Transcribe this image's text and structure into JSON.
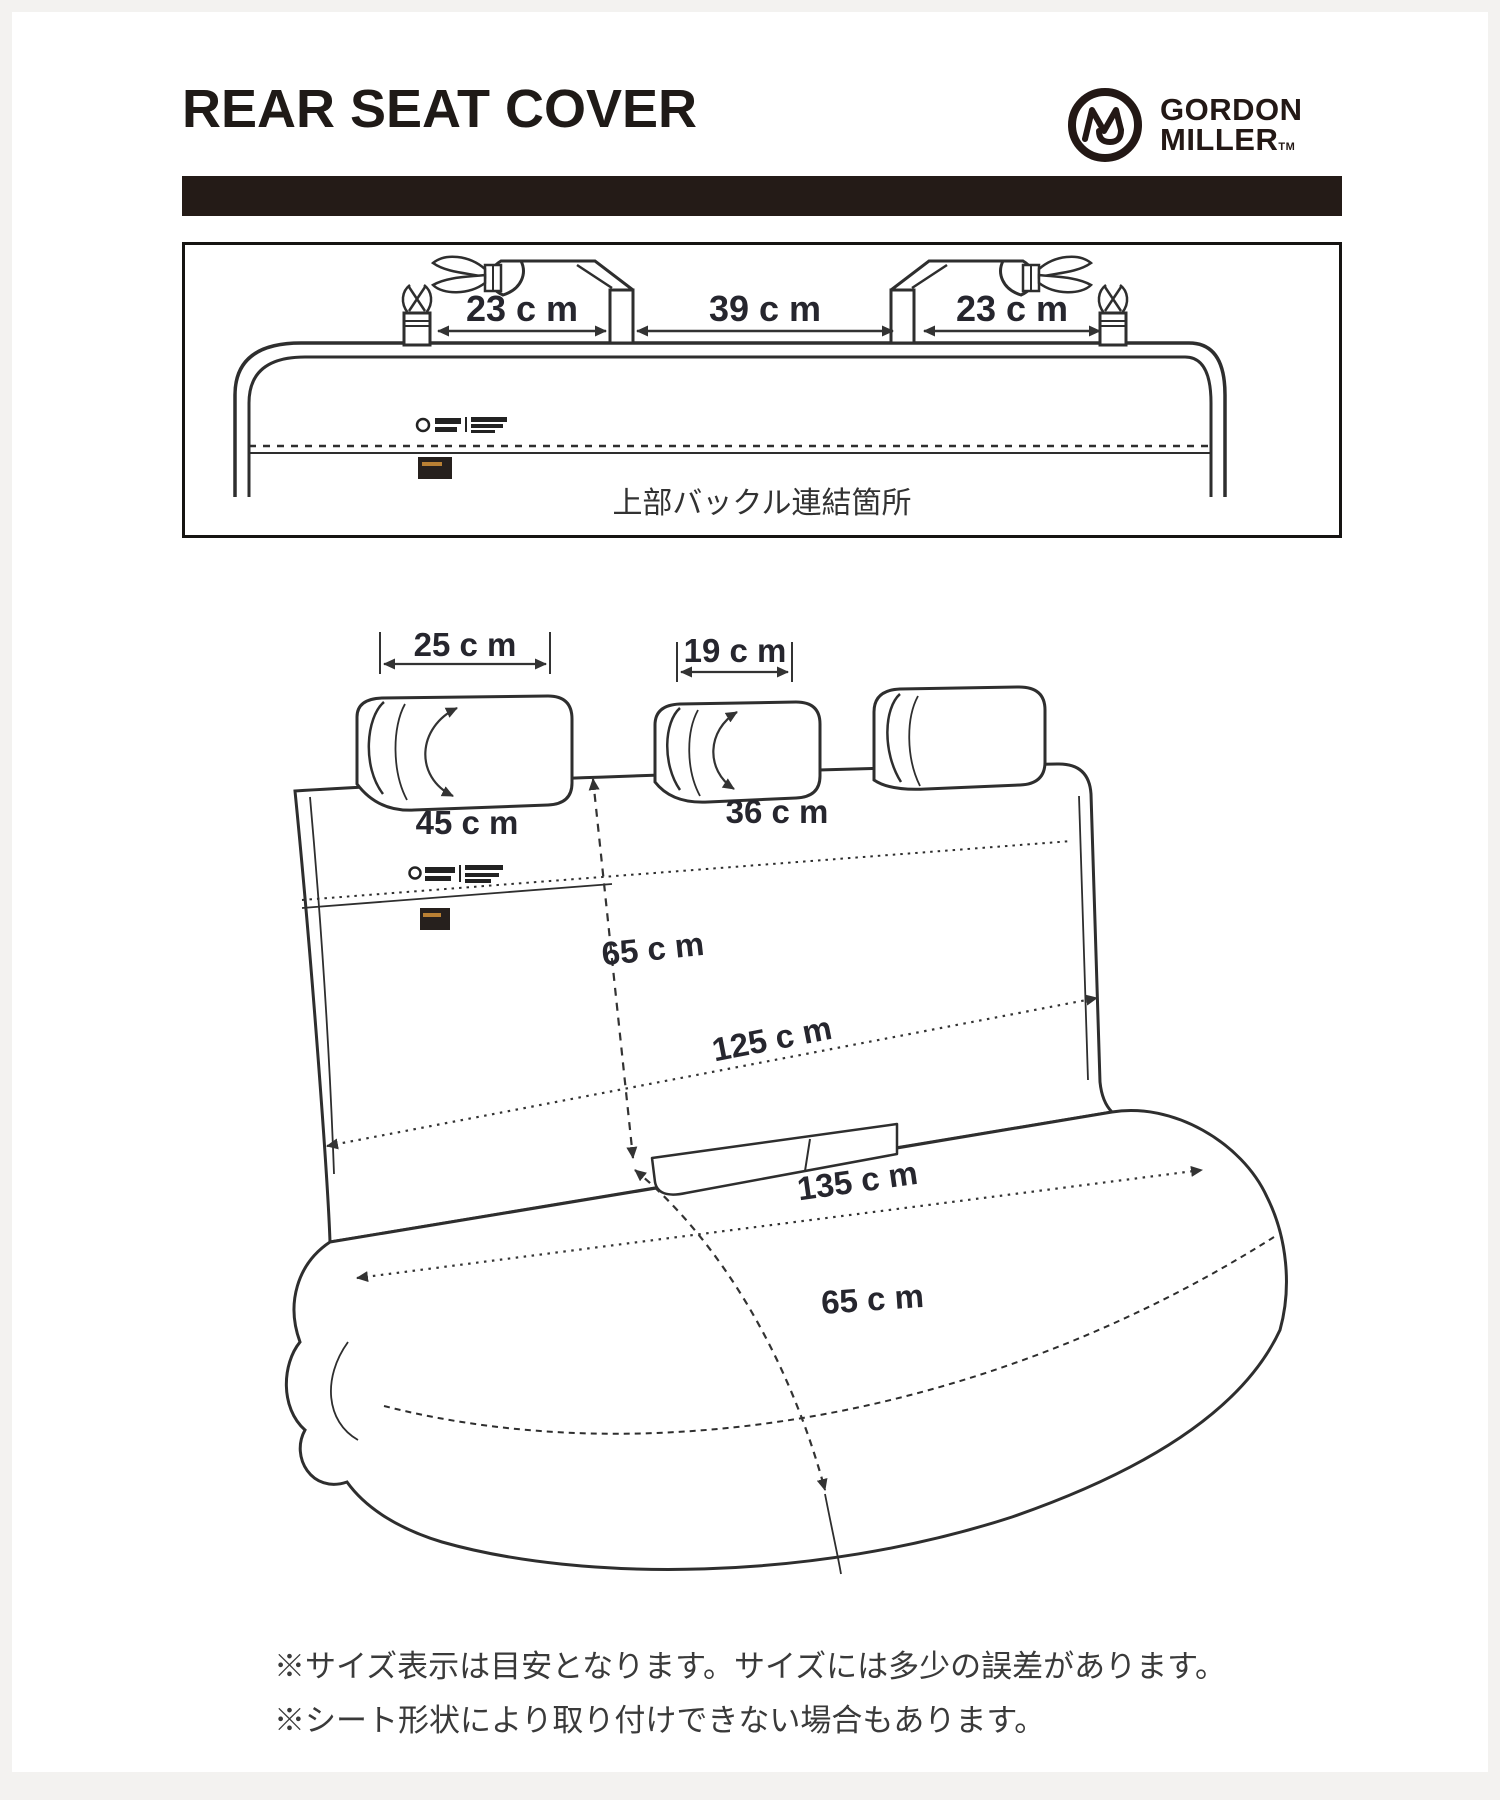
{
  "colors": {
    "ink": "#231815",
    "line": "#2e2e2e",
    "label": "#26262e"
  },
  "header": {
    "title": "REAR SEAT COVER",
    "brand_top": "GORDON",
    "brand_bottom": "MILLER",
    "brand_tm": "TM"
  },
  "top_view": {
    "dim_left": "23 c m",
    "dim_mid": "39 c m",
    "dim_right": "23 c m",
    "caption": "上部バックル連結箇所"
  },
  "seat_view": {
    "headrest_left_width": "25 c m",
    "headrest_left_girth": "45 c m",
    "headrest_mid_width": "19 c m",
    "headrest_mid_girth": "36 c m",
    "back_height": "65 c m",
    "back_width": "125 c m",
    "seat_width": "135 c m",
    "seat_depth": "65 c m"
  },
  "notes": [
    "※サイズ表示は目安となります。サイズには多少の誤差があります。",
    "※シート形状により取り付けできない場合もあります。"
  ]
}
